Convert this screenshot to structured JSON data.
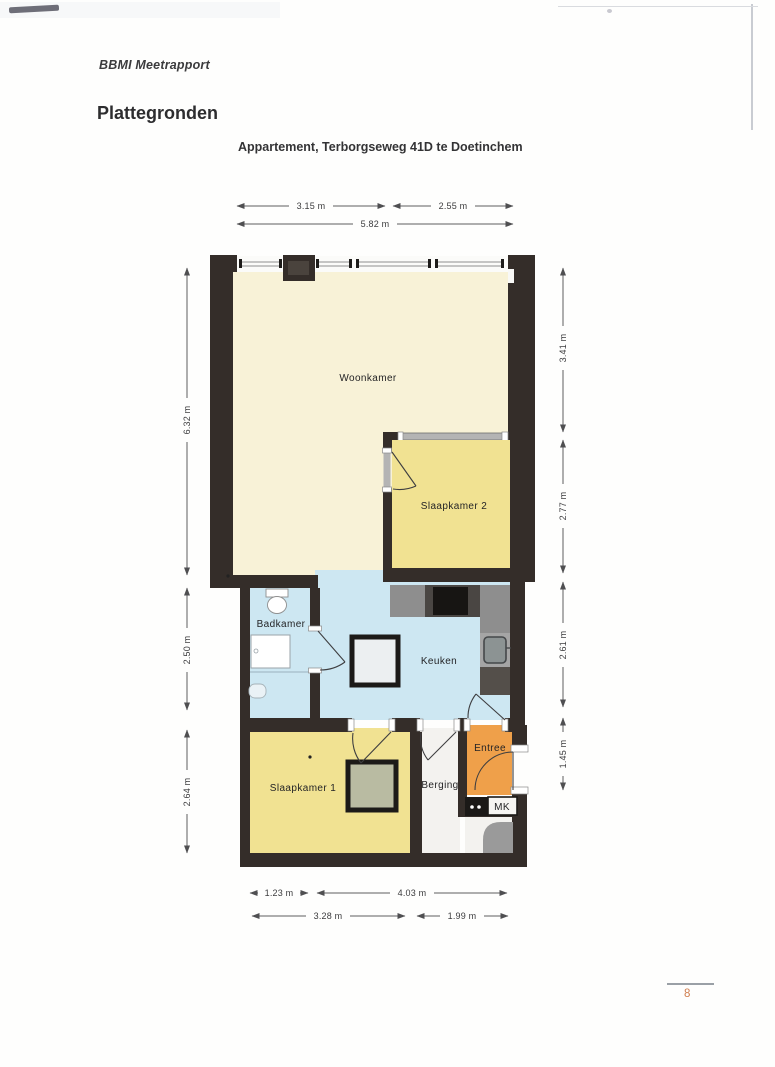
{
  "header": {
    "report_title": "BBMI Meetrapport",
    "page_title": "Plattegronden",
    "subtitle": "Appartement, Terborgseweg 41D te Doetinchem"
  },
  "plan": {
    "rooms": {
      "woonkamer": {
        "label": "Woonkamer",
        "fill": "#f8f2d7"
      },
      "slaapkamer2": {
        "label": "Slaapkamer 2",
        "fill": "#f1e292"
      },
      "badkamer": {
        "label": "Badkamer",
        "fill": "#cde7f2"
      },
      "keuken": {
        "label": "Keuken",
        "fill": "#cde7f2"
      },
      "slaapkamer1": {
        "label": "Slaapkamer 1",
        "fill": "#f1e292"
      },
      "berging": {
        "label": "Berging",
        "fill": "#f3f2ef"
      },
      "entree": {
        "label": "Entree",
        "fill": "#efa04a"
      },
      "mk": {
        "label": "MK",
        "fill": "#f6f5f2"
      }
    },
    "dims": {
      "top": [
        {
          "label": "3.15 m"
        },
        {
          "label": "2.55 m"
        },
        {
          "label": "5.82 m"
        }
      ],
      "left": [
        {
          "label": "6.32 m"
        },
        {
          "label": "2.50 m"
        },
        {
          "label": "2.64 m"
        }
      ],
      "right": [
        {
          "label": "3.41 m"
        },
        {
          "label": "2.77 m"
        },
        {
          "label": "2.61 m"
        },
        {
          "label": "1.45 m"
        }
      ],
      "bottom": [
        {
          "label": "1.23 m"
        },
        {
          "label": "4.03 m"
        },
        {
          "label": "3.28 m"
        },
        {
          "label": "1.99 m"
        }
      ]
    },
    "colors": {
      "wall": "#342d29",
      "counter_grey": "#8e8e8e",
      "stove_black": "#171513",
      "entree_orange": "#efa04a",
      "room_blue": "#cde7f2",
      "room_yellow": "#f1e292",
      "room_cream": "#f8f2d7"
    }
  },
  "footer": {
    "page_number": "8"
  }
}
